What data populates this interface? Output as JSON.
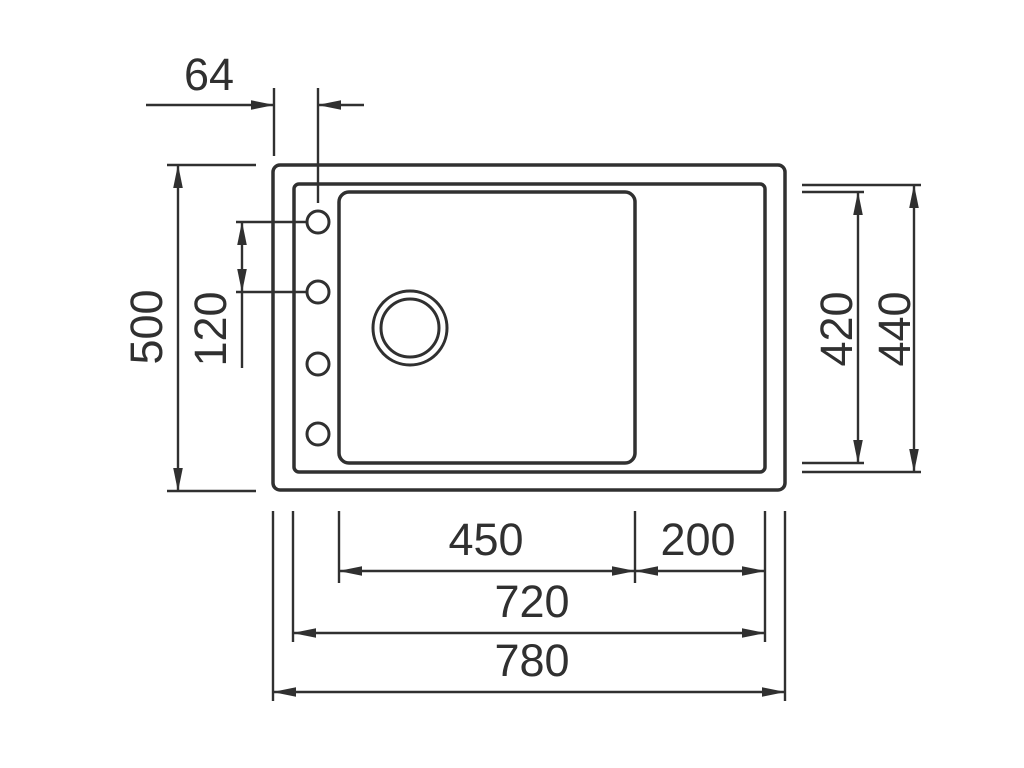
{
  "diagram": {
    "colors": {
      "line": "#303030",
      "background": "#ffffff"
    },
    "dimensions": {
      "tap_hole_offset": "64",
      "overall_depth": "500",
      "tap_hole_spacing": "120",
      "bowl_inner_depth": "420",
      "rim_inner_depth": "440",
      "bowl_width": "450",
      "drainer_width": "200",
      "rim_inner_width": "720",
      "overall_width": "780"
    }
  }
}
